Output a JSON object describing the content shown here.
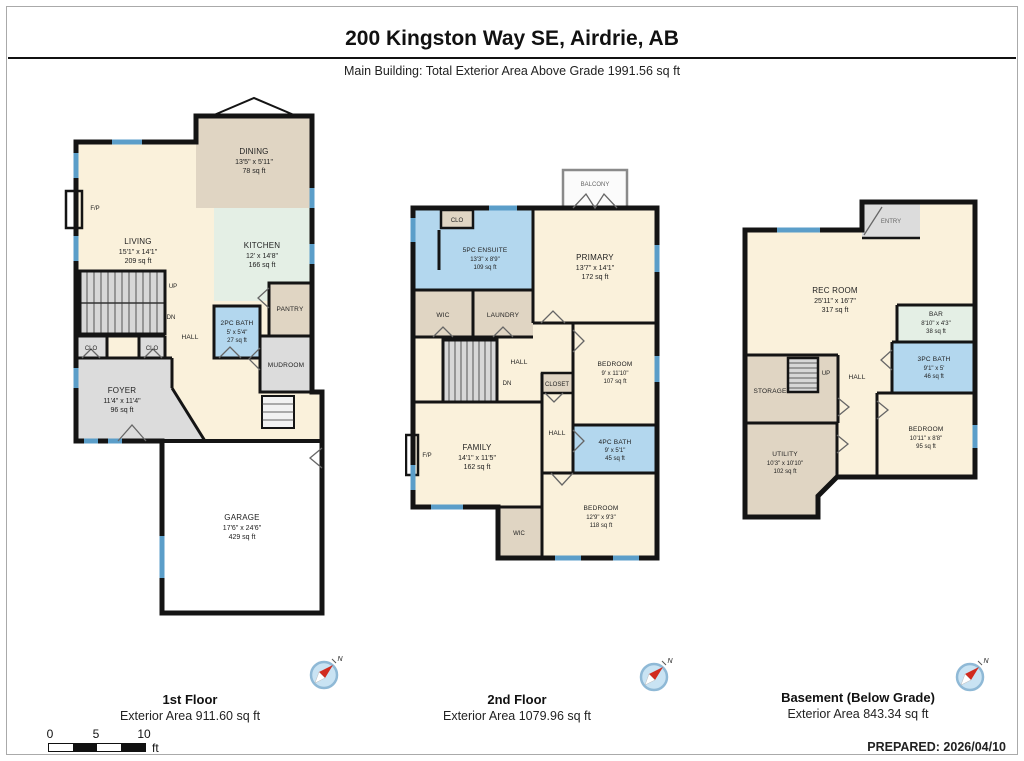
{
  "header": {
    "title": "200 Kingston Way SE, Airdrie, AB",
    "subtitle": "Main Building: Total Exterior Area Above Grade 1991.56 sq ft"
  },
  "colors": {
    "wall": "#141414",
    "window_blue": "#5b9ec9",
    "room_cream": "#faf1db",
    "room_tan": "#e0d5c3",
    "room_mint": "#e4efe5",
    "room_bath_blue": "#b3d7ee",
    "room_gray": "#dcdcdc",
    "compass_red": "#d12b1f",
    "compass_blue": "#c9e3f3"
  },
  "floor1": {
    "title": "1st Floor",
    "area": "Exterior Area 911.60 sq ft",
    "rooms": {
      "dining": {
        "name": "DINING",
        "dims": "13'5\" x 5'11\"",
        "area": "78 sq ft"
      },
      "living": {
        "name": "LIVING",
        "dims": "15'1\" x 14'1\"",
        "area": "209 sq ft"
      },
      "kitchen": {
        "name": "KITCHEN",
        "dims": "12' x 14'8\"",
        "area": "166 sq ft"
      },
      "bath": {
        "name": "2PC BATH",
        "dims": "5' x 5'4\"",
        "area": "27 sq ft"
      },
      "foyer": {
        "name": "FOYER",
        "dims": "11'4\" x 11'4\"",
        "area": "96 sq ft"
      },
      "garage": {
        "name": "GARAGE",
        "dims": "17'6\" x 24'6\"",
        "area": "429 sq ft"
      },
      "pantry": "PANTRY",
      "mudroom": "MUDROOM",
      "hall": "HALL",
      "clo": "CLO",
      "fp": "F/P",
      "up": "UP",
      "dn": "DN"
    }
  },
  "floor2": {
    "title": "2nd Floor",
    "area": "Exterior Area 1079.96 sq ft",
    "rooms": {
      "balcony": "BALCONY",
      "clo": "CLO",
      "ensuite": {
        "name": "5PC ENSUITE",
        "dims": "13'3\" x 8'9\"",
        "area": "109 sq ft"
      },
      "primary": {
        "name": "PRIMARY",
        "dims": "13'7\" x 14'1\"",
        "area": "172 sq ft"
      },
      "bedroom1": {
        "name": "BEDROOM",
        "dims": "9' x 11'10\"",
        "area": "107 sq ft"
      },
      "bath": {
        "name": "4PC BATH",
        "dims": "9' x 5'1\"",
        "area": "45 sq ft"
      },
      "family": {
        "name": "FAMILY",
        "dims": "14'1\" x 11'5\"",
        "area": "162 sq ft"
      },
      "bedroom2": {
        "name": "BEDROOM",
        "dims": "12'9\" x 9'3\"",
        "area": "118 sq ft"
      },
      "wic": "WIC",
      "laundry": "LAUNDRY",
      "hall": "HALL",
      "closet": "CLOSET",
      "fp": "F/P",
      "dn": "DN"
    }
  },
  "floor3": {
    "title": "Basement (Below Grade)",
    "area": "Exterior Area 843.34 sq ft",
    "rooms": {
      "entry": "ENTRY",
      "rec": {
        "name": "REC ROOM",
        "dims": "25'11\" x 16'7\"",
        "area": "317 sq ft"
      },
      "bar": {
        "name": "BAR",
        "dims": "8'10\" x 4'3\"",
        "area": "38 sq ft"
      },
      "bath": {
        "name": "3PC BATH",
        "dims": "9'1\" x 5'",
        "area": "46 sq ft"
      },
      "bedroom": {
        "name": "BEDROOM",
        "dims": "10'11\" x 8'8\"",
        "area": "95 sq ft"
      },
      "utility": {
        "name": "UTILITY",
        "dims": "10'3\" x 10'10\"",
        "area": "102 sq ft"
      },
      "storage": "STORAGE",
      "hall": "HALL",
      "up": "UP"
    }
  },
  "footer": {
    "prepared": "PREPARED: 2026/04/10",
    "compass_n": "N",
    "scale": {
      "t0": "0",
      "t5": "5",
      "t10": "10",
      "unit": "ft"
    }
  }
}
